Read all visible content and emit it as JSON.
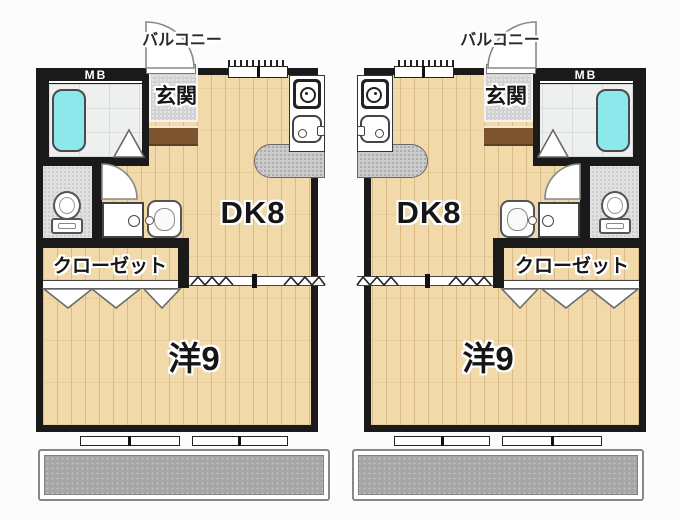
{
  "meta": {
    "type": "floorplan",
    "description": "Two mirrored 1DK apartment units, side by side"
  },
  "units": [
    {
      "id": "left",
      "meter_box": "MB",
      "entrance": "玄関",
      "dining_kitchen": "DK8",
      "closet": "クローゼット",
      "western_room": "洋9",
      "balcony": "バルコニー"
    },
    {
      "id": "right",
      "meter_box": "MB",
      "entrance": "玄関",
      "dining_kitchen": "DK8",
      "closet": "クローゼット",
      "western_room": "洋9",
      "balcony": "バルコニー"
    }
  ],
  "palette": {
    "wall": "#1a1a1a",
    "wood_floor": "#f1d9a9",
    "bathtub": "#8ce8ea",
    "bath_tile": "#eef0ef",
    "entrance_tile": "#d2d2d2",
    "balcony_floor": "#a6a6a6",
    "kitchen_counter_top": "#cbcbcb",
    "entrance_step": "#7c5530"
  },
  "icons": [
    "bathtub-icon",
    "stove-icon",
    "kitchen-sink-icon",
    "toilet-icon",
    "washing-machine-pan-icon",
    "washbasin-icon",
    "door-swing-arc",
    "folding-door-triangles",
    "accordion-divider-zigzag",
    "window-tick-marks"
  ]
}
